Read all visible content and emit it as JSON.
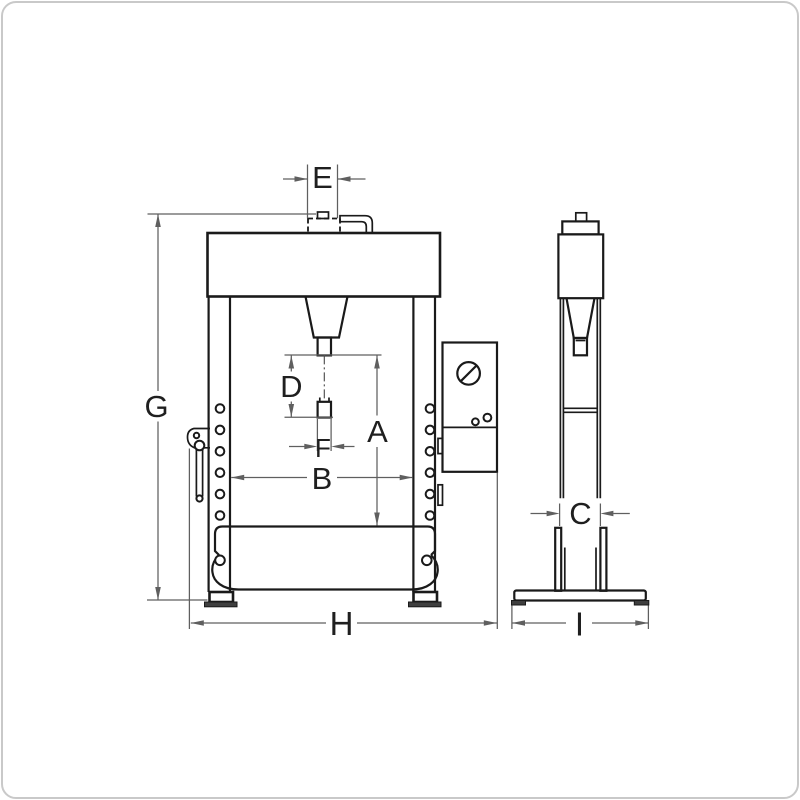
{
  "figure": {
    "kind": "technical line drawing",
    "subject": "hydraulic workshop press shown in front view and side view with dimension callout letters"
  },
  "labels": {
    "A": "A",
    "B": "B",
    "C": "C",
    "D": "D",
    "E": "E",
    "F": "F",
    "G": "G",
    "H": "H",
    "I": "I"
  },
  "colors": {
    "object_line": "#1a1a1a",
    "dimension_line": "#5f5f5f",
    "label_text": "#1f1f1f",
    "foot_pad": "#3f3f3f",
    "background": "#ffffff",
    "frame_border": "#c9c9c9"
  }
}
